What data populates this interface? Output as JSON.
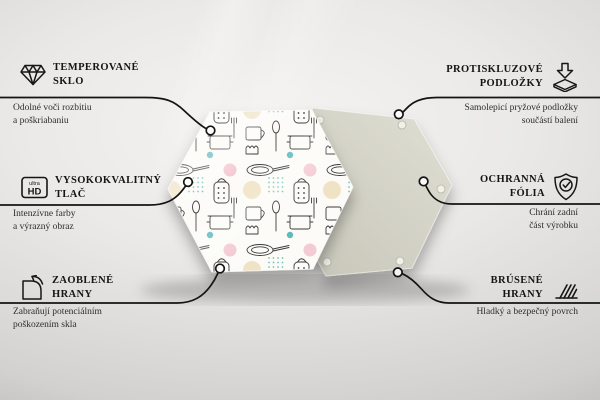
{
  "features": {
    "left": [
      {
        "icon": "diamond-icon",
        "title1": "TEMPEROVANÉ",
        "title2": "SKLO",
        "desc1": "Odolné voči rozbitiu",
        "desc2": "a poškriabaniu"
      },
      {
        "icon": "ultra-hd-badge-icon",
        "title1": "VYSOKOKVALITNÝ",
        "title2": "TLAČ",
        "desc1": "Intenzívne farby",
        "desc2": "a výrazný obraz"
      },
      {
        "icon": "rounded-corner-icon",
        "title1": "ZAOBLENÉ",
        "title2": "HRANY",
        "desc1": "Zabraňují potenciálním",
        "desc2": "poškozením skla"
      }
    ],
    "right": [
      {
        "icon": "anti-slip-pads-icon",
        "title1": "PROTISKLUZOVÉ",
        "title2": "PODLOŽKY",
        "desc1": "Samolepicí pryžové podložky",
        "desc2": "součástí balení"
      },
      {
        "icon": "shield-check-icon",
        "title1": "OCHRANNÁ",
        "title2": "FÓLIA",
        "desc1": "Chrání zadní",
        "desc2": "část výrobku"
      },
      {
        "icon": "ground-edges-icon",
        "title1": "BRÚSENÉ",
        "title2": "HRANY",
        "desc1": "Hladký a bezpečný povrch",
        "desc2": ""
      }
    ]
  },
  "badge": {
    "ultra": "ultra",
    "hd": "HD"
  },
  "product": {
    "front_board": "hexagonal glass board with kitchen doodle print",
    "back_board": "hexagonal back side with self-adhesive pads"
  },
  "colors": {
    "callout_line": "#141414",
    "back_hexagon": "#d6d5c8",
    "front_board_bg": "#fcfbf7",
    "accent_teal": "#4fb3b6",
    "accent_pink": "#f3c6d1",
    "accent_beige": "#eedfbc"
  }
}
